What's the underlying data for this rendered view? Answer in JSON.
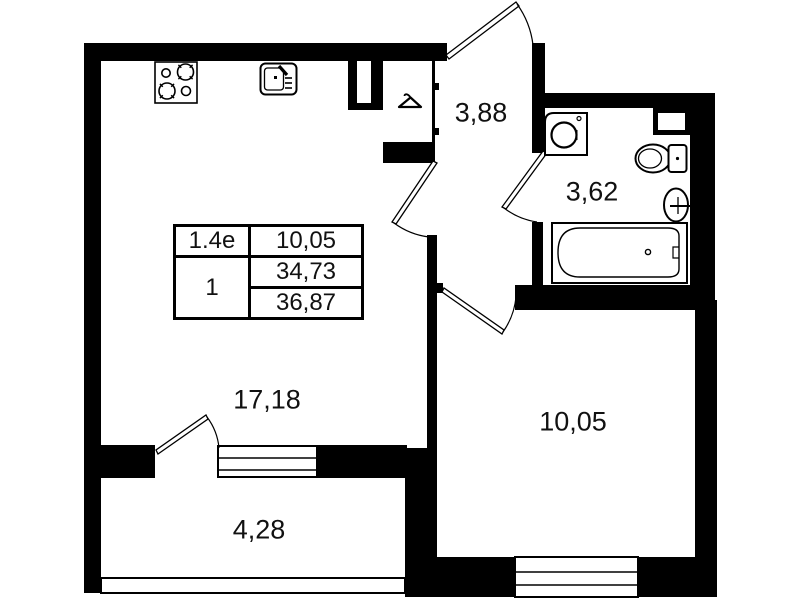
{
  "plan_title": "one-room apartment floor plan",
  "rooms": {
    "living_kitchen": {
      "area": "17,18"
    },
    "hallway": {
      "area": "3,88"
    },
    "bathroom": {
      "area": "3,62"
    },
    "bedroom": {
      "area": "10,05"
    },
    "balcony": {
      "area": "4,28"
    }
  },
  "info_table": {
    "unit_type": "1.4e",
    "room_count": "1",
    "kitchen_living_area": "10,05",
    "living_area_total": "34,73",
    "total_area": "36,87"
  },
  "icons": [
    "stove-icon",
    "kitchen-sink-icon",
    "hanger-icon",
    "washing-machine-icon",
    "toilet-icon",
    "washbasin-icon",
    "bathtub-icon"
  ],
  "colors": {
    "wall": "#000000",
    "background": "#ffffff",
    "text": "#111111"
  }
}
